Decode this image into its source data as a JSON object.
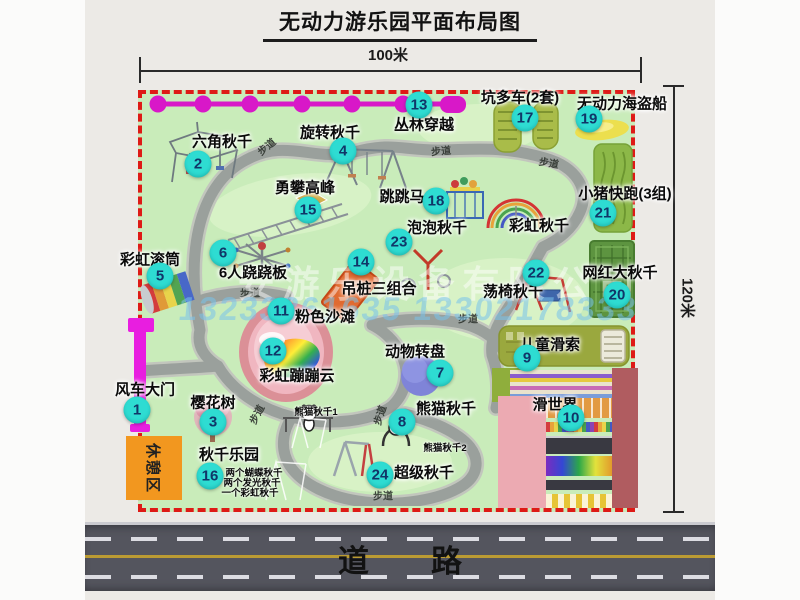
{
  "title": "无动力游乐园平面布局图",
  "dimensions": {
    "top": "100米",
    "right": "120米"
  },
  "road": {
    "label": "道　　路"
  },
  "watermark": {
    "company": "安游乐设备有限公司",
    "phones": "13233861635 13302178333"
  },
  "rest_area": {
    "label": "休憩区"
  },
  "colors": {
    "map_green": "#c9ecba",
    "border_red": "#de1a16",
    "marker_teal": "#2edcd2",
    "zipline_magenta": "#d818c8",
    "gate_magenta": "#e81ee0",
    "rest_orange": "#f2971f",
    "road_gray": "#54555e",
    "walkway_gray": "#9aa09c"
  },
  "attractions": [
    {
      "id": "windmill-gate",
      "num": "1",
      "name": "风车大门",
      "marker": {
        "x": 137,
        "y": 410
      },
      "label": {
        "x": 145,
        "y": 389
      }
    },
    {
      "id": "hexagon-swing",
      "num": "2",
      "name": "六角秋千",
      "marker": {
        "x": 198,
        "y": 164
      },
      "label": {
        "x": 222,
        "y": 141
      }
    },
    {
      "id": "cherry-tree",
      "num": "3",
      "name": "樱花树",
      "marker": {
        "x": 213,
        "y": 422
      },
      "label": {
        "x": 213,
        "y": 402
      }
    },
    {
      "id": "rotating-swing",
      "num": "4",
      "name": "旋转秋千",
      "marker": {
        "x": 343,
        "y": 151
      },
      "label": {
        "x": 330,
        "y": 132
      }
    },
    {
      "id": "rainbow-roller",
      "num": "5",
      "name": "彩虹滚筒",
      "marker": {
        "x": 160,
        "y": 276
      },
      "label": {
        "x": 150,
        "y": 259
      }
    },
    {
      "id": "seesaw-6p",
      "num": "6",
      "name": "6人跷跷板",
      "marker": {
        "x": 223,
        "y": 253
      },
      "label": {
        "x": 253,
        "y": 272
      }
    },
    {
      "id": "animal-turntable",
      "num": "7",
      "name": "动物转盘",
      "marker": {
        "x": 440,
        "y": 373
      },
      "label": {
        "x": 415,
        "y": 351
      }
    },
    {
      "id": "panda-swing",
      "num": "8",
      "name": "熊猫秋千",
      "marker": {
        "x": 402,
        "y": 422
      },
      "label": {
        "x": 446,
        "y": 408
      }
    },
    {
      "id": "kids-zipline",
      "num": "9",
      "name": "儿童滑索",
      "marker": {
        "x": 527,
        "y": 358
      },
      "label": {
        "x": 550,
        "y": 344
      }
    },
    {
      "id": "slide-world",
      "num": "10",
      "name": "滑世界",
      "marker": {
        "x": 571,
        "y": 418
      },
      "label": {
        "x": 555,
        "y": 404
      }
    },
    {
      "id": "pink-beach",
      "num": "11",
      "name": "粉色沙滩",
      "marker": {
        "x": 281,
        "y": 311
      },
      "label": {
        "x": 325,
        "y": 316
      }
    },
    {
      "id": "rainbow-cloud",
      "num": "12",
      "name": "彩虹蹦蹦云",
      "marker": {
        "x": 273,
        "y": 351
      },
      "label": {
        "x": 297,
        "y": 375
      }
    },
    {
      "id": "jungle-crossing",
      "num": "13",
      "name": "丛林穿越",
      "marker": {
        "x": 419,
        "y": 105
      },
      "label": {
        "x": 424,
        "y": 124
      }
    },
    {
      "id": "hanging-piles",
      "num": "14",
      "name": "吊桩三组合",
      "marker": {
        "x": 361,
        "y": 262
      },
      "label": {
        "x": 379,
        "y": 288
      }
    },
    {
      "id": "climbing-peak",
      "num": "15",
      "name": "勇攀高峰",
      "marker": {
        "x": 308,
        "y": 210
      },
      "label": {
        "x": 305,
        "y": 187
      }
    },
    {
      "id": "swing-paradise",
      "num": "16",
      "name": "秋千乐园",
      "marker": {
        "x": 210,
        "y": 476
      },
      "label": {
        "x": 229,
        "y": 454
      }
    },
    {
      "id": "pit-carts",
      "num": "17",
      "name": "坑多车(2套)",
      "marker": {
        "x": 525,
        "y": 118
      },
      "label": {
        "x": 520,
        "y": 97
      }
    },
    {
      "id": "jumping-horse",
      "num": "18",
      "name": "跳跳马",
      "marker": {
        "x": 436,
        "y": 201
      },
      "label": {
        "x": 402,
        "y": 196
      }
    },
    {
      "id": "pirate-ship",
      "num": "19",
      "name": "无动力海盗船",
      "marker": {
        "x": 589,
        "y": 119
      },
      "label": {
        "x": 622,
        "y": 103
      }
    },
    {
      "id": "big-swing",
      "num": "20",
      "name": "网红大秋千",
      "marker": {
        "x": 617,
        "y": 295
      },
      "label": {
        "x": 620,
        "y": 272
      }
    },
    {
      "id": "piggy-run",
      "num": "21",
      "name": "小猪快跑(3组)",
      "marker": {
        "x": 603,
        "y": 213
      },
      "label": {
        "x": 625,
        "y": 193
      }
    },
    {
      "id": "swing-chair",
      "num": "22",
      "name": "荡椅秋千",
      "marker": {
        "x": 536,
        "y": 273
      },
      "label": {
        "x": 513,
        "y": 291
      }
    },
    {
      "id": "bubble-swing",
      "num": "23",
      "name": "泡泡秋千",
      "marker": {
        "x": 399,
        "y": 242
      },
      "label": {
        "x": 437,
        "y": 227
      }
    },
    {
      "id": "super-swing",
      "num": "24",
      "name": "超级秋千",
      "marker": {
        "x": 380,
        "y": 475
      },
      "label": {
        "x": 424,
        "y": 472
      }
    }
  ],
  "sub_labels": [
    {
      "id": "rainbow-swing-label",
      "text": "彩虹秋千",
      "x": 539,
      "y": 225,
      "size": "normal"
    },
    {
      "id": "panda-swing-1-label",
      "text": "熊猫秋千1",
      "x": 316,
      "y": 411,
      "size": "small"
    },
    {
      "id": "panda-swing-2-label",
      "text": "熊猫秋千2",
      "x": 445,
      "y": 447,
      "size": "small"
    },
    {
      "id": "swing-note-1",
      "text": "两个蝴蝶秋千",
      "x": 254,
      "y": 472,
      "size": "small"
    },
    {
      "id": "swing-note-2",
      "text": "两个发光秋千",
      "x": 252,
      "y": 482,
      "size": "small"
    },
    {
      "id": "swing-note-3",
      "text": "一个彩虹秋千",
      "x": 250,
      "y": 492,
      "size": "small"
    }
  ],
  "path_labels": [
    {
      "text": "步道",
      "x": 266,
      "y": 146,
      "rot": -40
    },
    {
      "text": "步道",
      "x": 441,
      "y": 150,
      "rot": -5
    },
    {
      "text": "步道",
      "x": 549,
      "y": 162,
      "rot": 10
    },
    {
      "text": "步道",
      "x": 250,
      "y": 292,
      "rot": 0
    },
    {
      "text": "步道",
      "x": 468,
      "y": 318,
      "rot": 0
    },
    {
      "text": "步道",
      "x": 256,
      "y": 414,
      "rot": -62
    },
    {
      "text": "步道",
      "x": 379,
      "y": 415,
      "rot": -72
    },
    {
      "text": "步道",
      "x": 383,
      "y": 495,
      "rot": 0
    }
  ]
}
